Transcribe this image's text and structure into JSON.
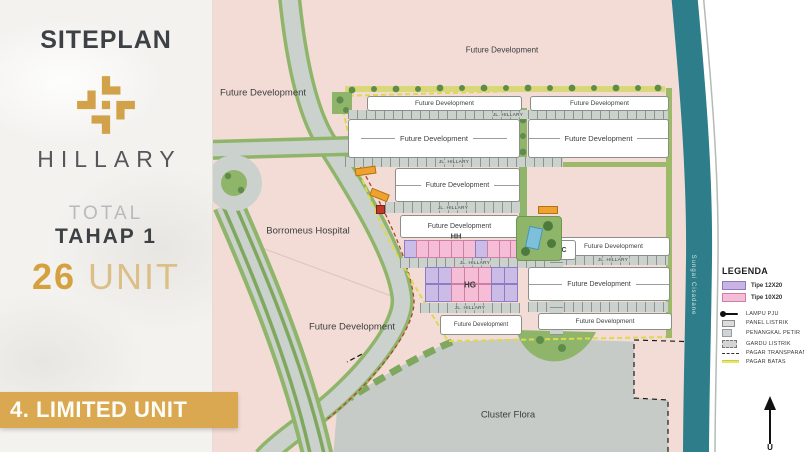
{
  "sidebar": {
    "title": "SITEPLAN",
    "brand": "HILLARY",
    "total_label": "TOTAL",
    "phase_label": "TAHAP 1",
    "unit_count": "26",
    "unit_word": " UNIT",
    "banner": "4. LIMITED UNIT"
  },
  "labels": {
    "future_development": "Future Development",
    "hospital": "Borromeus Hospital",
    "cluster_flora": "Cluster Flora",
    "river": "Sungai Cisadane",
    "street": "JL. HILLARY",
    "row_hh": "HH",
    "row_hg": "HG",
    "block_rc": "RC"
  },
  "legend": {
    "title": "LEGENDA",
    "types": [
      {
        "label": "Tipe 12X20",
        "color": "#c9b3e4"
      },
      {
        "label": "Tipe 10X20",
        "color": "#f5bcd7"
      }
    ],
    "items": [
      {
        "icon": "lampu-pju-icon",
        "label": "LAMPU PJU"
      },
      {
        "icon": "panel-listrik-icon",
        "label": "PANEL LISTRIK"
      },
      {
        "icon": "penangkal-petir-icon",
        "label": "PENANGKAL PETIR"
      },
      {
        "icon": "gardu-listrik-icon",
        "label": "GARDU LISTRIK"
      },
      {
        "icon": "pagar-transparan-icon",
        "label": "PAGAR TRANSPARAN"
      },
      {
        "icon": "pagar-batas-icon",
        "label": "PAGAR BATAS"
      }
    ]
  },
  "units": {
    "hh_cells": [
      "p",
      "k",
      "k",
      "k",
      "k",
      "k",
      "p",
      "k",
      "k",
      "k",
      "k",
      "p"
    ],
    "hg_top_cells": [
      "p",
      "p",
      "k",
      "k",
      "k",
      "p",
      "p"
    ],
    "hg_bottom_cells": [
      "p",
      "p",
      "k",
      "k",
      "k",
      "p",
      "p"
    ]
  },
  "compass": {
    "label": "U"
  },
  "colors": {
    "gold": "#d9a850",
    "river_teal": "#2e7d8a",
    "map_pink": "#f3dcd6",
    "road_gray": "#cbd1cc",
    "type_12x20": "#c9b3e4",
    "type_10x20": "#f5bcd7"
  }
}
